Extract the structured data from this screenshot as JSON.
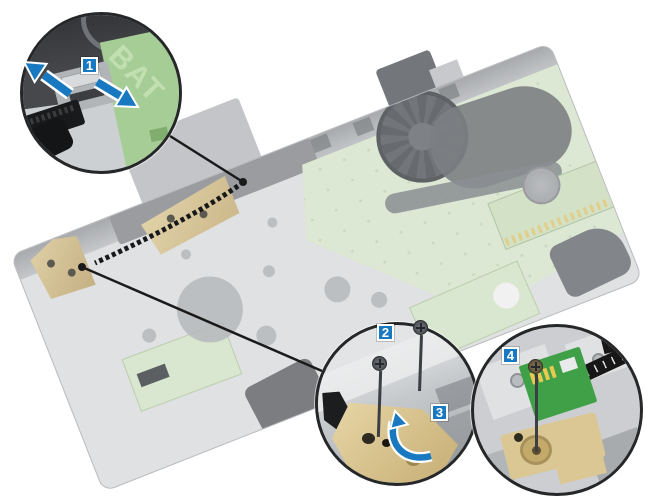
{
  "figure": {
    "background": "#ffffff",
    "description_visible_text_only": true
  },
  "colors": {
    "accent": "#1879c0",
    "leader": "#1a1a1a",
    "hinge_gold": "#c6ad74",
    "board_green": "#3fa047",
    "mobo_green": "#d2e1c8"
  },
  "callouts": [
    {
      "label": "1"
    },
    {
      "label": "2"
    },
    {
      "label": "3"
    },
    {
      "label": "4"
    }
  ],
  "texts": {
    "battery_silkscreen": "BAT"
  }
}
